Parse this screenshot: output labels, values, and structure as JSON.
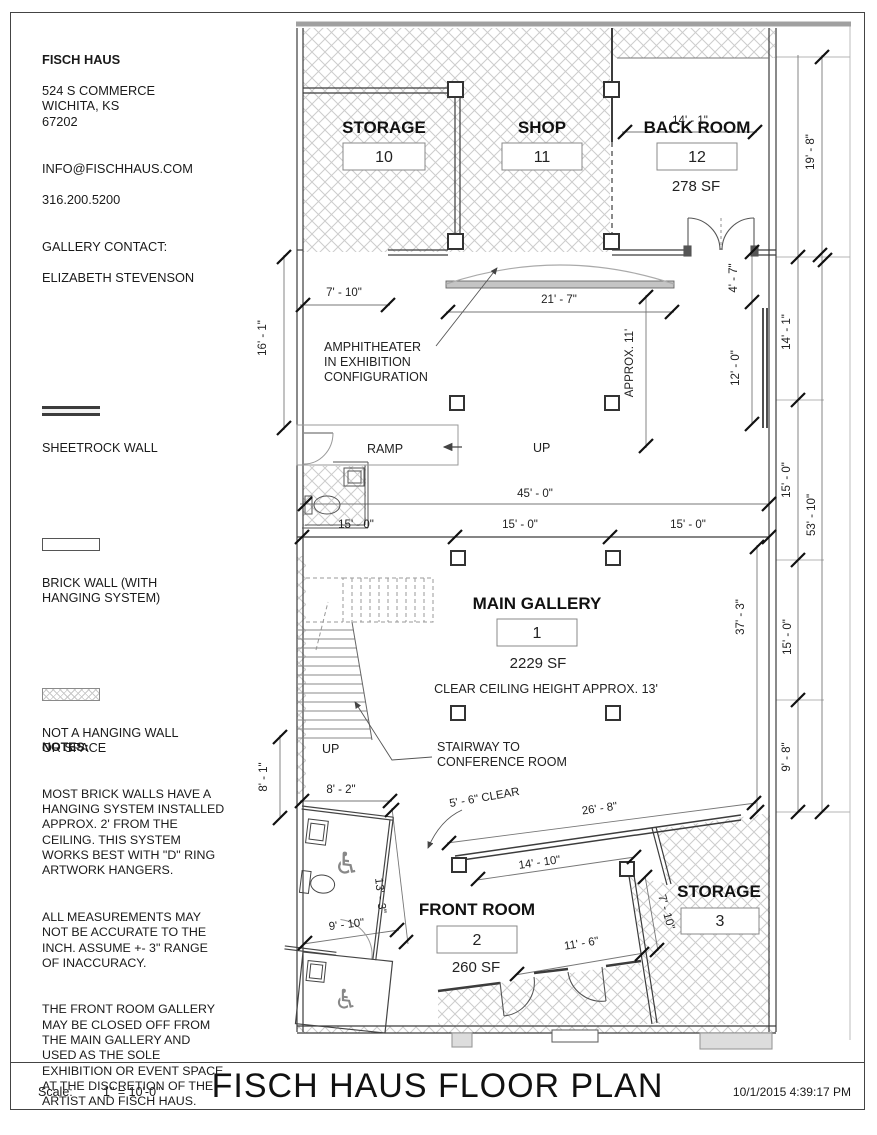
{
  "info": {
    "name": "FISCH HAUS",
    "address": "524 S COMMERCE\nWICHITA, KS\n67202",
    "email": "INFO@FISCHHAUS.COM",
    "phone": "316.200.5200",
    "contact_label": "GALLERY CONTACT:",
    "contact_name": "ELIZABETH STEVENSON"
  },
  "legend": {
    "sheetrock": "SHEETROCK WALL",
    "brick": "BRICK WALL (WITH\nHANGING SYSTEM)",
    "hatch": "NOT A HANGING WALL\nOR SPACE"
  },
  "notes": {
    "heading": "NOTES:",
    "p1": "MOST BRICK WALLS HAVE A\nHANGING SYSTEM INSTALLED\nAPPROX. 2' FROM THE\nCEILING. THIS SYSTEM\nWORKS BEST WITH \"D\" RING\nARTWORK HANGERS.",
    "p2": "ALL MEASUREMENTS MAY\nNOT BE ACCURATE TO THE\nINCH. ASSUME +- 3\" RANGE\nOF INACCURACY.",
    "p3": "THE FRONT ROOM GALLERY\nMAY BE CLOSED OFF FROM\nTHE MAIN GALLERY AND\nUSED AS THE SOLE\nEXHIBITION OR EVENT SPACE\nAT THE DISCRETION OF THE\nARTIST AND FISCH HAUS."
  },
  "rooms": {
    "storage10": {
      "name": "STORAGE",
      "num": "10"
    },
    "shop": {
      "name": "SHOP",
      "num": "11"
    },
    "backroom": {
      "name": "BACK ROOM",
      "num": "12",
      "area": "278 SF"
    },
    "gallery": {
      "name": "MAIN GALLERY",
      "num": "1",
      "area": "2229 SF",
      "ceiling": "CLEAR CEILING HEIGHT APPROX. 13'"
    },
    "frontroom": {
      "name": "FRONT ROOM",
      "num": "2",
      "area": "260 SF"
    },
    "storage3": {
      "name": "STORAGE",
      "num": "3"
    }
  },
  "annotations": {
    "amphi1": "AMPHITHEATER",
    "amphi2": "IN EXHIBITION",
    "amphi3": "CONFIGURATION",
    "stair1": "STAIRWAY TO",
    "stair2": "CONFERENCE ROOM",
    "ramp": "RAMP",
    "up_ramp": "UP",
    "up_stairs": "UP"
  },
  "dims": {
    "t14_1": "14' - 1\"",
    "l7_10": "7' - 10\"",
    "c21_7": "21' - 7\"",
    "r4_7": "4' - 7\"",
    "approx11": "APPROX. 11'",
    "l16_1": "16' - 1\"",
    "r14_1": "14' - 1\"",
    "r12_0": "12' - 0\"",
    "r19_8": "19' - 8\"",
    "c45_0": "45' - 0\"",
    "c15_0a": "15' - 0\"",
    "c15_0b": "15' - 0\"",
    "c15_0c": "15' - 0\"",
    "r15_0a": "15' - 0\"",
    "r53_10": "53' - 10\"",
    "r15_0b": "15' - 0\"",
    "r37_3": "37' - 3\"",
    "r9_8": "9' - 8\"",
    "l8_1": "8' - 1\"",
    "l8_2": "8' - 2\"",
    "c5_6": "5' - 6\" CLEAR",
    "c26_8": "26' - 8\"",
    "c14_10": "14' - 10\"",
    "l13_3": "13' - 3\"",
    "l9_10": "9' - 10\"",
    "c11_6": "11' - 6\"",
    "r7_10": "7' - 10\""
  },
  "titleblock": {
    "scale_label": "Scale:",
    "scale_value": "1\" = 10'-0\"",
    "title": "FISCH HAUS FLOOR PLAN",
    "datetime": "10/1/2015 4:39:17 PM"
  },
  "icons": {
    "wheelchair": "♿"
  }
}
